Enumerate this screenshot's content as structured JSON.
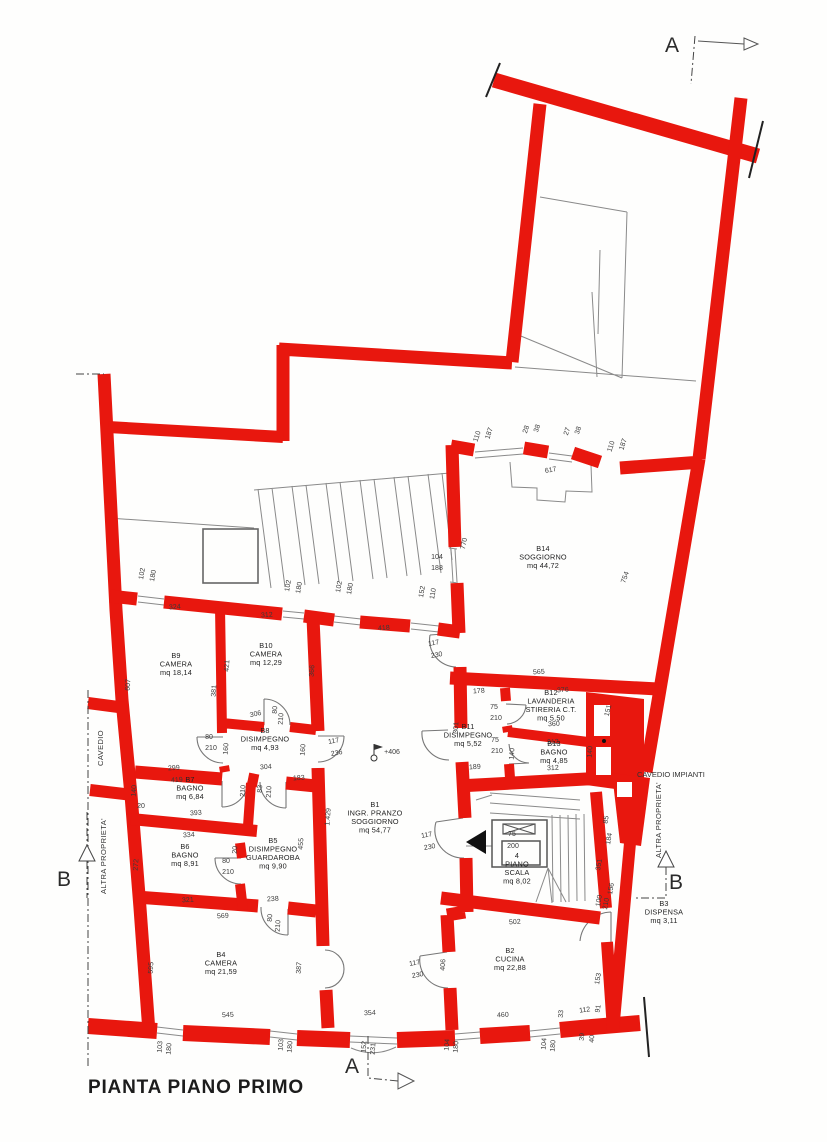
{
  "title": "PIANTA PIANO PRIMO",
  "colors": {
    "wall": "#e8170e",
    "line": "#8a8a8a",
    "text": "#3a3a3a"
  },
  "section_markers": {
    "a_top": "A",
    "a_bottom": "A",
    "b_left": "B",
    "b_right": "B"
  },
  "annotations": {
    "cavedio": "CAVEDIO",
    "altra_proprieta_left": "ALTRA PROPRIETA'",
    "altra_proprieta_right": "ALTRA PROPRIETA'",
    "cavedio_impianti": "CAVEDIO IMPIANTI"
  },
  "rooms": [
    {
      "id": "B1",
      "lines": [
        "B1",
        "INGR. PRANZO",
        "SOGGIORNO",
        "mq 54,77"
      ],
      "x": 375,
      "y": 807
    },
    {
      "id": "B2",
      "lines": [
        "B2",
        "CUCINA",
        "mq 22,88"
      ],
      "x": 510,
      "y": 953
    },
    {
      "id": "B3",
      "lines": [
        "B3",
        "DISPENSA",
        "mq 3,11"
      ],
      "x": 664,
      "y": 906
    },
    {
      "id": "B4",
      "lines": [
        "B4",
        "CAMERA",
        "mq 21,59"
      ],
      "x": 221,
      "y": 957
    },
    {
      "id": "B5",
      "lines": [
        "B5",
        "DISIMPEGNO",
        "GUARDAROBA",
        "mq 9,90"
      ],
      "x": 273,
      "y": 843
    },
    {
      "id": "B6",
      "lines": [
        "B6",
        "BAGNO",
        "mq 8,91"
      ],
      "x": 185,
      "y": 849
    },
    {
      "id": "B7",
      "lines": [
        "B7",
        "BAGNO",
        "mq 6,84"
      ],
      "x": 190,
      "y": 782
    },
    {
      "id": "B8",
      "lines": [
        "B8",
        "DISIMPEGNO",
        "mq 4,93"
      ],
      "x": 265,
      "y": 733
    },
    {
      "id": "B9",
      "lines": [
        "B9",
        "CAMERA",
        "mq 18,14"
      ],
      "x": 176,
      "y": 658
    },
    {
      "id": "B10",
      "lines": [
        "B10",
        "CAMERA",
        "mq 12,29"
      ],
      "x": 266,
      "y": 648
    },
    {
      "id": "B11",
      "lines": [
        "B11",
        "DISIMPEGNO",
        "mq 5,52"
      ],
      "x": 468,
      "y": 729
    },
    {
      "id": "B12",
      "lines": [
        "B12",
        "LAVANDERIA",
        "STIRERIA C.T.",
        "mq 5,50"
      ],
      "x": 551,
      "y": 695
    },
    {
      "id": "B13",
      "lines": [
        "B13",
        "BAGNO",
        "mq 4,85"
      ],
      "x": 554,
      "y": 746
    },
    {
      "id": "B14",
      "lines": [
        "B14",
        "SOGGIORNO",
        "mq 44,72"
      ],
      "x": 543,
      "y": 551
    },
    {
      "id": "PS",
      "lines": [
        "4",
        "PIANO",
        "SCALA",
        "mq 8,02"
      ],
      "x": 517,
      "y": 858
    }
  ],
  "dimensions": [
    {
      "t": "110",
      "x": 479,
      "y": 437,
      "r": -72
    },
    {
      "t": "187",
      "x": 491,
      "y": 434,
      "r": -72
    },
    {
      "t": "28",
      "x": 528,
      "y": 430,
      "r": -72
    },
    {
      "t": "38",
      "x": 539,
      "y": 429,
      "r": -72
    },
    {
      "t": "27",
      "x": 569,
      "y": 432,
      "r": -72
    },
    {
      "t": "38",
      "x": 580,
      "y": 431,
      "r": -72
    },
    {
      "t": "110",
      "x": 613,
      "y": 447,
      "r": -72
    },
    {
      "t": "187",
      "x": 625,
      "y": 445,
      "r": -72
    },
    {
      "t": "617",
      "x": 551,
      "y": 472,
      "r": -10
    },
    {
      "t": "104",
      "x": 437,
      "y": 559,
      "r": 0
    },
    {
      "t": "188",
      "x": 437,
      "y": 570,
      "r": 0
    },
    {
      "t": "770",
      "x": 466,
      "y": 544,
      "r": -78
    },
    {
      "t": "754",
      "x": 627,
      "y": 578,
      "r": -70
    },
    {
      "t": "102",
      "x": 144,
      "y": 574,
      "r": -80
    },
    {
      "t": "180",
      "x": 155,
      "y": 576,
      "r": -80
    },
    {
      "t": "102",
      "x": 290,
      "y": 586,
      "r": -80
    },
    {
      "t": "180",
      "x": 301,
      "y": 588,
      "r": -80
    },
    {
      "t": "102",
      "x": 341,
      "y": 587,
      "r": -80
    },
    {
      "t": "180",
      "x": 352,
      "y": 589,
      "r": -80
    },
    {
      "t": "152",
      "x": 424,
      "y": 592,
      "r": -80
    },
    {
      "t": "110",
      "x": 435,
      "y": 594,
      "r": -80
    },
    {
      "t": "324",
      "x": 175,
      "y": 609,
      "r": -4
    },
    {
      "t": "312",
      "x": 267,
      "y": 617,
      "r": -4
    },
    {
      "t": "418",
      "x": 384,
      "y": 630,
      "r": -4
    },
    {
      "t": "607",
      "x": 130,
      "y": 685,
      "r": -86
    },
    {
      "t": "421",
      "x": 229,
      "y": 666,
      "r": -86
    },
    {
      "t": "381",
      "x": 216,
      "y": 691,
      "r": -86
    },
    {
      "t": "366",
      "x": 314,
      "y": 671,
      "r": -86
    },
    {
      "t": "306",
      "x": 256,
      "y": 716,
      "r": -12
    },
    {
      "t": "80",
      "x": 277,
      "y": 710,
      "r": -86
    },
    {
      "t": "210",
      "x": 283,
      "y": 719,
      "r": -86
    },
    {
      "t": "80",
      "x": 209,
      "y": 739,
      "r": 0
    },
    {
      "t": "210",
      "x": 211,
      "y": 750,
      "r": 0
    },
    {
      "t": "160",
      "x": 228,
      "y": 749,
      "r": -86
    },
    {
      "t": "160",
      "x": 305,
      "y": 750,
      "r": -86
    },
    {
      "t": "117",
      "x": 334,
      "y": 743,
      "r": -10
    },
    {
      "t": "236",
      "x": 337,
      "y": 755,
      "r": -10
    },
    {
      "t": "299",
      "x": 174,
      "y": 770,
      "r": -4
    },
    {
      "t": "419",
      "x": 177,
      "y": 782,
      "r": -4
    },
    {
      "t": "304",
      "x": 266,
      "y": 769,
      "r": -4
    },
    {
      "t": "183",
      "x": 299,
      "y": 780,
      "r": -4
    },
    {
      "t": "210",
      "x": 245,
      "y": 791,
      "r": -86
    },
    {
      "t": "83",
      "x": 262,
      "y": 789,
      "r": -86
    },
    {
      "t": "210",
      "x": 271,
      "y": 792,
      "r": -86
    },
    {
      "t": "140",
      "x": 136,
      "y": 791,
      "r": -86
    },
    {
      "t": "20",
      "x": 141,
      "y": 808,
      "r": 0
    },
    {
      "t": "393",
      "x": 196,
      "y": 815,
      "r": -4
    },
    {
      "t": "334",
      "x": 189,
      "y": 837,
      "r": -4
    },
    {
      "t": "272",
      "x": 138,
      "y": 865,
      "r": -86
    },
    {
      "t": "455",
      "x": 303,
      "y": 844,
      "r": -86
    },
    {
      "t": "1.429",
      "x": 330,
      "y": 817,
      "r": -86
    },
    {
      "t": "20",
      "x": 237,
      "y": 850,
      "r": -86
    },
    {
      "t": "80",
      "x": 226,
      "y": 863,
      "r": 0
    },
    {
      "t": "210",
      "x": 228,
      "y": 874,
      "r": 0
    },
    {
      "t": "321",
      "x": 188,
      "y": 902,
      "r": -4
    },
    {
      "t": "238",
      "x": 273,
      "y": 901,
      "r": -4
    },
    {
      "t": "569",
      "x": 223,
      "y": 918,
      "r": -4
    },
    {
      "t": "80",
      "x": 272,
      "y": 918,
      "r": -86
    },
    {
      "t": "210",
      "x": 280,
      "y": 926,
      "r": -86
    },
    {
      "t": "595",
      "x": 153,
      "y": 968,
      "r": -86
    },
    {
      "t": "387",
      "x": 301,
      "y": 968,
      "r": -86
    },
    {
      "t": "545",
      "x": 228,
      "y": 1017,
      "r": -3
    },
    {
      "t": "103",
      "x": 162,
      "y": 1047,
      "r": -86
    },
    {
      "t": "180",
      "x": 171,
      "y": 1049,
      "r": -86
    },
    {
      "t": "103",
      "x": 283,
      "y": 1045,
      "r": -86
    },
    {
      "t": "180",
      "x": 292,
      "y": 1047,
      "r": -86
    },
    {
      "t": "354",
      "x": 370,
      "y": 1015,
      "r": -3
    },
    {
      "t": "152",
      "x": 366,
      "y": 1047,
      "r": -86
    },
    {
      "t": "231",
      "x": 375,
      "y": 1049,
      "r": -86
    },
    {
      "t": "104",
      "x": 449,
      "y": 1045,
      "r": -86
    },
    {
      "t": "180",
      "x": 458,
      "y": 1047,
      "r": -86
    },
    {
      "t": "104",
      "x": 546,
      "y": 1044,
      "r": -86
    },
    {
      "t": "180",
      "x": 555,
      "y": 1046,
      "r": -86
    },
    {
      "t": "+406",
      "x": 392,
      "y": 754,
      "r": 0
    },
    {
      "t": "117",
      "x": 434,
      "y": 645,
      "r": -10
    },
    {
      "t": "230",
      "x": 437,
      "y": 657,
      "r": -10
    },
    {
      "t": "117",
      "x": 427,
      "y": 837,
      "r": -10
    },
    {
      "t": "230",
      "x": 430,
      "y": 849,
      "r": -10
    },
    {
      "t": "406",
      "x": 445,
      "y": 965,
      "r": -86
    },
    {
      "t": "117",
      "x": 415,
      "y": 965,
      "r": -10
    },
    {
      "t": "230",
      "x": 418,
      "y": 977,
      "r": -10
    },
    {
      "t": "565",
      "x": 539,
      "y": 674,
      "r": -4
    },
    {
      "t": "178",
      "x": 479,
      "y": 693,
      "r": -4
    },
    {
      "t": "376",
      "x": 563,
      "y": 692,
      "r": -4
    },
    {
      "t": "301",
      "x": 458,
      "y": 728,
      "r": -86
    },
    {
      "t": "75",
      "x": 494,
      "y": 709,
      "r": 0
    },
    {
      "t": "210",
      "x": 496,
      "y": 720,
      "r": 0
    },
    {
      "t": "75",
      "x": 495,
      "y": 742,
      "r": 0
    },
    {
      "t": "210",
      "x": 497,
      "y": 753,
      "r": 0
    },
    {
      "t": "140",
      "x": 514,
      "y": 754,
      "r": -86
    },
    {
      "t": "360",
      "x": 554,
      "y": 726,
      "r": -3
    },
    {
      "t": "312",
      "x": 553,
      "y": 744,
      "r": -3
    },
    {
      "t": "312",
      "x": 553,
      "y": 770,
      "r": -3
    },
    {
      "t": "140",
      "x": 592,
      "y": 752,
      "r": -86
    },
    {
      "t": "151",
      "x": 610,
      "y": 711,
      "r": -76
    },
    {
      "t": "189",
      "x": 475,
      "y": 769,
      "r": -4
    },
    {
      "t": "75",
      "x": 512,
      "y": 836,
      "r": 0
    },
    {
      "t": "200",
      "x": 513,
      "y": 848,
      "r": 0
    },
    {
      "t": "85",
      "x": 608,
      "y": 820,
      "r": -80
    },
    {
      "t": "184",
      "x": 611,
      "y": 839,
      "r": -80
    },
    {
      "t": "351",
      "x": 601,
      "y": 865,
      "r": -80
    },
    {
      "t": "156",
      "x": 613,
      "y": 889,
      "r": -80
    },
    {
      "t": "100",
      "x": 601,
      "y": 901,
      "r": -80
    },
    {
      "t": "210",
      "x": 608,
      "y": 904,
      "r": -80
    },
    {
      "t": "502",
      "x": 515,
      "y": 924,
      "r": -4
    },
    {
      "t": "153",
      "x": 600,
      "y": 979,
      "r": -80
    },
    {
      "t": "460",
      "x": 503,
      "y": 1017,
      "r": -4
    },
    {
      "t": "33",
      "x": 563,
      "y": 1014,
      "r": -86
    },
    {
      "t": "112",
      "x": 585,
      "y": 1012,
      "r": -8
    },
    {
      "t": "91",
      "x": 600,
      "y": 1009,
      "r": -80
    },
    {
      "t": "39",
      "x": 584,
      "y": 1037,
      "r": -86
    },
    {
      "t": "40",
      "x": 594,
      "y": 1039,
      "r": -86
    }
  ]
}
